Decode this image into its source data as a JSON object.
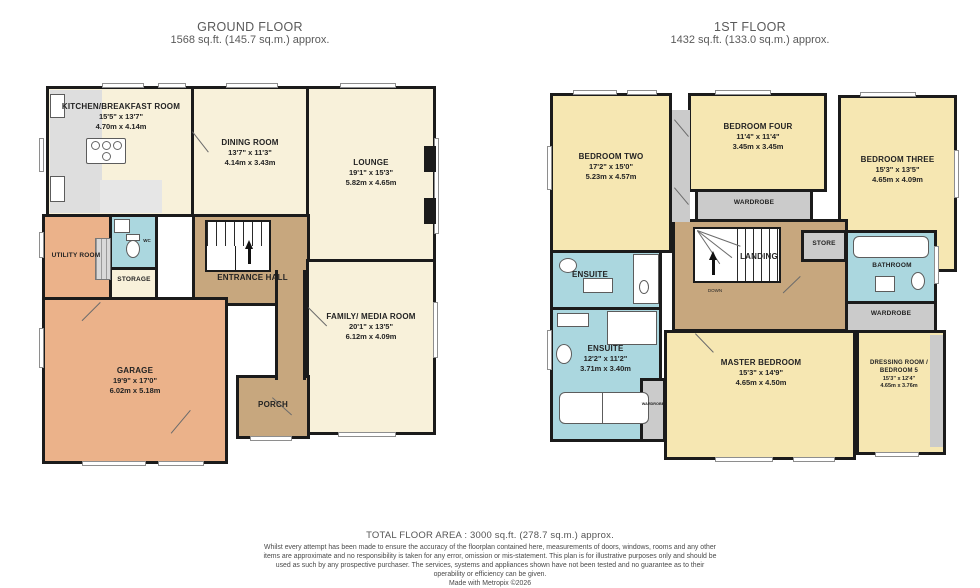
{
  "header": {
    "ground": {
      "title": "GROUND FLOOR",
      "area": "1568 sq.ft. (145.7 sq.m.) approx."
    },
    "first": {
      "title": "1ST FLOOR",
      "area": "1432 sq.ft. (133.0 sq.m.) approx."
    }
  },
  "rooms": {
    "kitchen": {
      "name": "KITCHEN/BREAKFAST ROOM",
      "imperial": "15'5\" x 13'7\"",
      "metric": "4.70m x 4.14m"
    },
    "dining": {
      "name": "DINING ROOM",
      "imperial": "13'7\" x 11'3\"",
      "metric": "4.14m x 3.43m"
    },
    "lounge": {
      "name": "LOUNGE",
      "imperial": "19'1\" x 15'3\"",
      "metric": "5.82m x 4.65m"
    },
    "utility": {
      "name": "UTILITY ROOM"
    },
    "wc": {
      "name": "WC"
    },
    "storage": {
      "name": "STORAGE"
    },
    "entrance": {
      "name": "ENTRANCE HALL"
    },
    "family": {
      "name": "FAMILY/ MEDIA ROOM",
      "imperial": "20'1\" x 13'5\"",
      "metric": "6.12m x 4.09m"
    },
    "garage": {
      "name": "GARAGE",
      "imperial": "19'9\" x 17'0\"",
      "metric": "6.02m x 5.18m"
    },
    "porch": {
      "name": "PORCH"
    },
    "bedroom_two": {
      "name": "BEDROOM TWO",
      "imperial": "17'2\" x 15'0\"",
      "metric": "5.23m x 4.57m"
    },
    "bedroom_four": {
      "name": "BEDROOM FOUR",
      "imperial": "11'4\" x 11'4\"",
      "metric": "3.45m x 3.45m"
    },
    "bedroom_three": {
      "name": "BEDROOM THREE",
      "imperial": "15'3\" x 13'5\"",
      "metric": "4.65m x 4.09m"
    },
    "wardrobe_b4": {
      "name": "WARDROBE"
    },
    "ensuite_one": {
      "name": "ENSUITE"
    },
    "landing": {
      "name": "LANDING",
      "sub": "DOWN"
    },
    "store": {
      "name": "STORE"
    },
    "bathroom": {
      "name": "BATHROOM"
    },
    "wardrobe_bath": {
      "name": "WARDROBE"
    },
    "ensuite_two": {
      "name": "ENSUITE",
      "imperial": "12'2\" x 11'2\"",
      "metric": "3.71m x 3.40m"
    },
    "wardrobe_master": {
      "name": "WARDROBE"
    },
    "master": {
      "name": "MASTER BEDROOM",
      "imperial": "15'3\" x 14'9\"",
      "metric": "4.65m x 4.50m"
    },
    "dressing": {
      "name": "DRESSING ROOM / BEDROOM 5",
      "imperial": "15'3\" x 12'4\"",
      "metric": "4.65m x 3.76m"
    }
  },
  "footer": {
    "total": "TOTAL FLOOR AREA : 3000 sq.ft. (278.7 sq.m.) approx.",
    "disclaimer": "Whilst every attempt has been made to ensure the accuracy of the floorplan contained here, measurements of doors, windows, rooms and any other items are approximate and no responsibility is taken for any error, omission or mis-statement. This plan is for illustrative purposes only and should be used as such by any prospective purchaser. The services, systems and appliances shown have not been tested and no guarantee as to their operability or efficiency can be given.",
    "credit": "Made with Metropix ©2026"
  },
  "colors": {
    "wall": "#1b1b1b",
    "room_cream": "#F8F1DA",
    "room_yellow": "#F6E7B2",
    "hall_tan": "#C7A77E",
    "garage_peach": "#EBB28A",
    "wet_blue": "#ABD7DF",
    "storage_grey": "#CBCBCB"
  }
}
